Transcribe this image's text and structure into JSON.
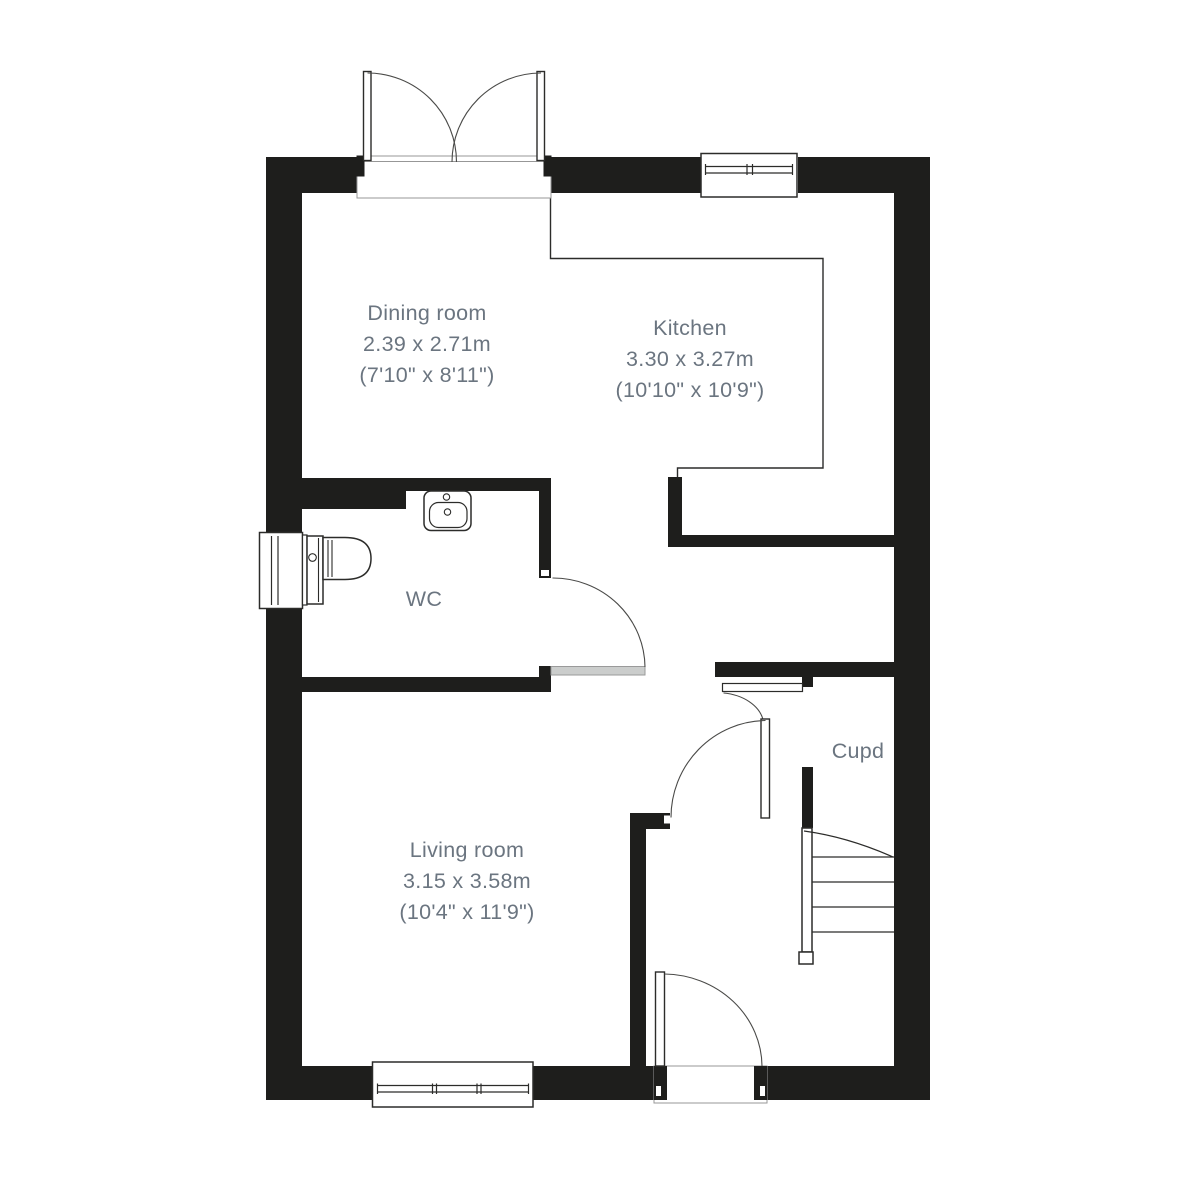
{
  "plan_type": "floor-plan",
  "rooms": [
    {
      "label": "Dining room",
      "metric": "2.39 x 2.71m",
      "imperial": "(7'10\" x 8'11\")"
    },
    {
      "label": "Kitchen",
      "metric": "3.30 x 3.27m",
      "imperial": "(10'10\" x 10'9\")"
    },
    {
      "label": "WC"
    },
    {
      "label": "Living room",
      "metric": "3.15 x 3.58m",
      "imperial": "(10'4\" x 11'9\")"
    },
    {
      "label": "Cupd"
    }
  ],
  "colors": {
    "wall": "#1e1e1c",
    "label_text": "#6b7580",
    "thin_line": "#2c2c2a",
    "arc_line": "#4a4a48",
    "door_leaf_fill": "#cbcdcc",
    "threshold_line": "#979797",
    "background": "#ffffff"
  }
}
